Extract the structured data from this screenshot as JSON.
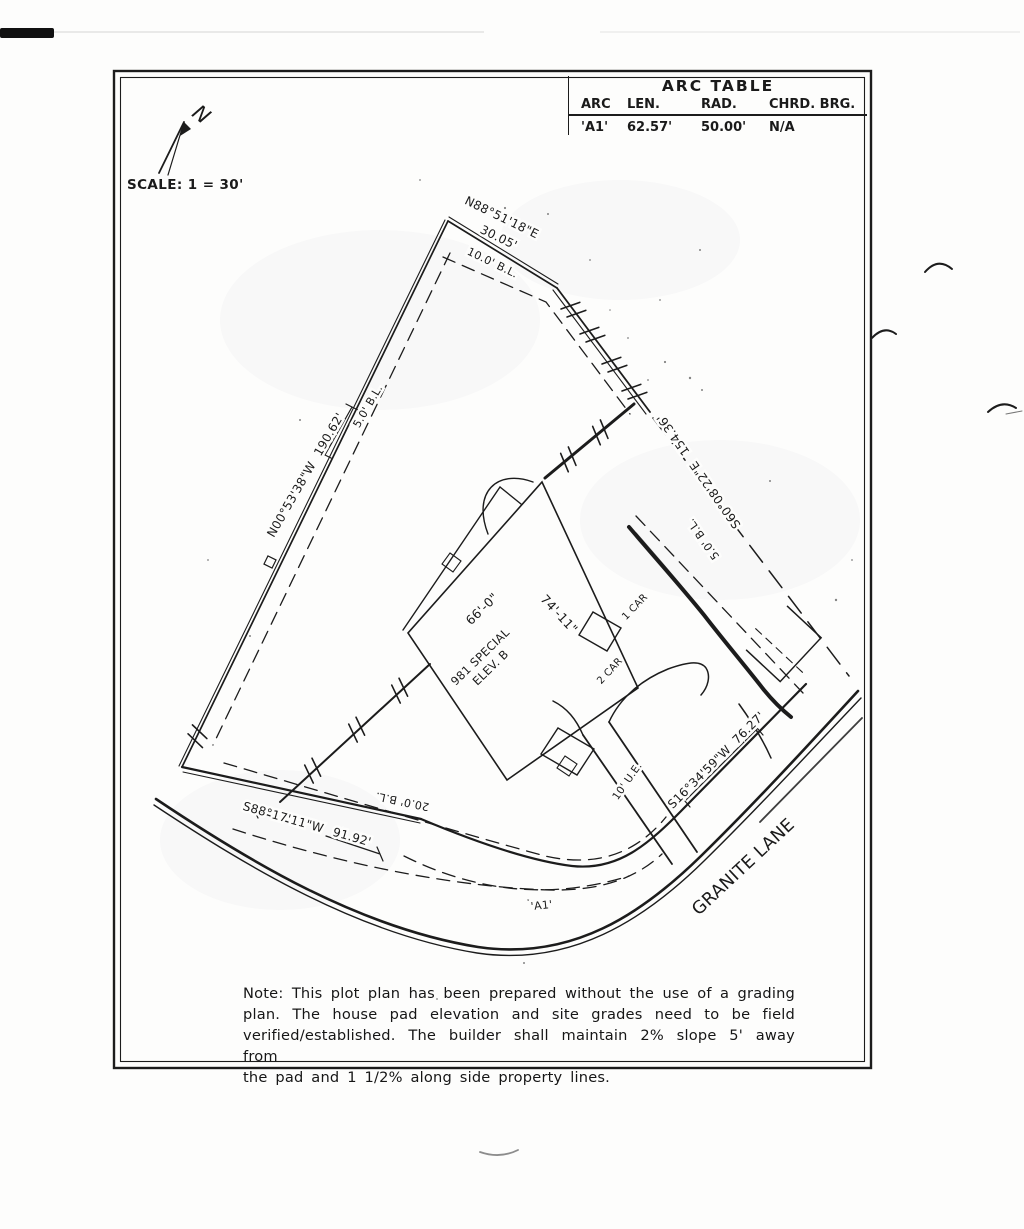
{
  "page": {
    "scale_label": "SCALE: 1 = 30'",
    "north_label": "N"
  },
  "arc_table": {
    "title": "ARC TABLE",
    "headers": [
      "ARC",
      "LEN.",
      "RAD.",
      "CHRD. BRG."
    ],
    "row": [
      "'A1'",
      "62.57'",
      "50.00'",
      "N/A"
    ]
  },
  "bearings": {
    "north_edge": {
      "bearing": "N88°51'18\"E",
      "distance": "30.05'"
    },
    "west_edge": {
      "bearing": "N00°53'38\"W",
      "distance": "190.62'"
    },
    "southeast_edge": {
      "bearing": "S60°08'22\"E",
      "distance": "154.36'"
    },
    "south_edge": {
      "bearing": "S88°17'11\"W",
      "distance": "91.92'"
    },
    "frontage_edge": {
      "bearing": "S16°34'59\"W",
      "distance": "76.27'"
    }
  },
  "building_lines": {
    "north": "10.0' B.L.",
    "west": "5.0' B.L.",
    "southeast": "5.0' B.L.",
    "south": "20.0' B.L."
  },
  "house": {
    "model": "981 SPECIAL",
    "elevation": "ELEV. B",
    "width": "66'-0\"",
    "length": "74'-11\"",
    "garage_one": "1 CAR",
    "garage_two": "2 CAR"
  },
  "street": {
    "name": "GRANITE LANE"
  },
  "labels": {
    "arc": "'A1'",
    "easement": "10' U.E."
  },
  "note": {
    "lines": [
      "Note: This plot plan has been prepared without the use of a grading",
      "plan.  The house pad elevation and site grades need to be field",
      "verified/established.  The builder shall maintain 2% slope 5' away from",
      "the pad and 1 1/2% along side property lines."
    ]
  }
}
